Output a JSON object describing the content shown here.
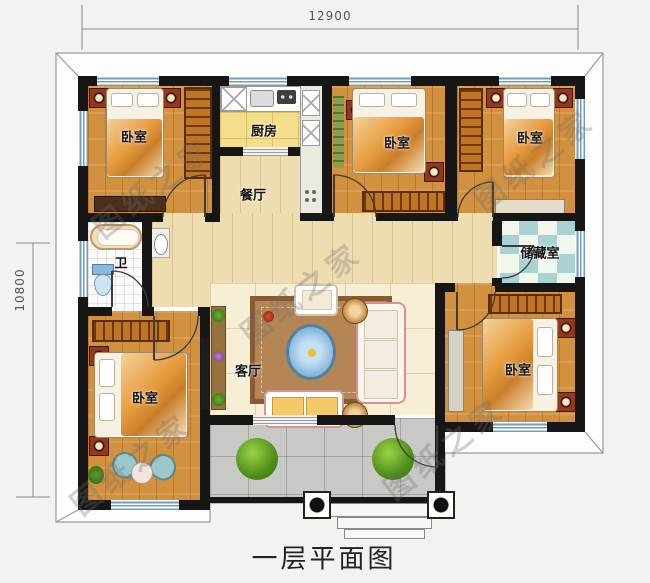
{
  "title": "一层平面图",
  "watermark": "图纸之家",
  "dimensions": {
    "width": "12900",
    "height": "10800"
  },
  "rooms": {
    "bedroom_tl": "卧室",
    "kitchen": "厨房",
    "bedroom_tm": "卧室",
    "bedroom_tr": "卧室",
    "dining": "餐厅",
    "bathroom": "卫",
    "storage": "储藏室",
    "bedroom_bl": "卧室",
    "living": "客厅",
    "bedroom_br": "卧室"
  },
  "colors": {
    "wall": "#161616",
    "window_glass": "#6e9ec2",
    "wood_bedroom": "#d2913f",
    "wood_hall": "#efddb2",
    "tile_living": "#f7eed6",
    "tile_kitchen": "#f4de8c",
    "tile_storage": "#a9d3d3",
    "tile_porch": "#c8c8c4",
    "wardrobe": "#c27425",
    "eave_line": "#9a9a9a"
  }
}
